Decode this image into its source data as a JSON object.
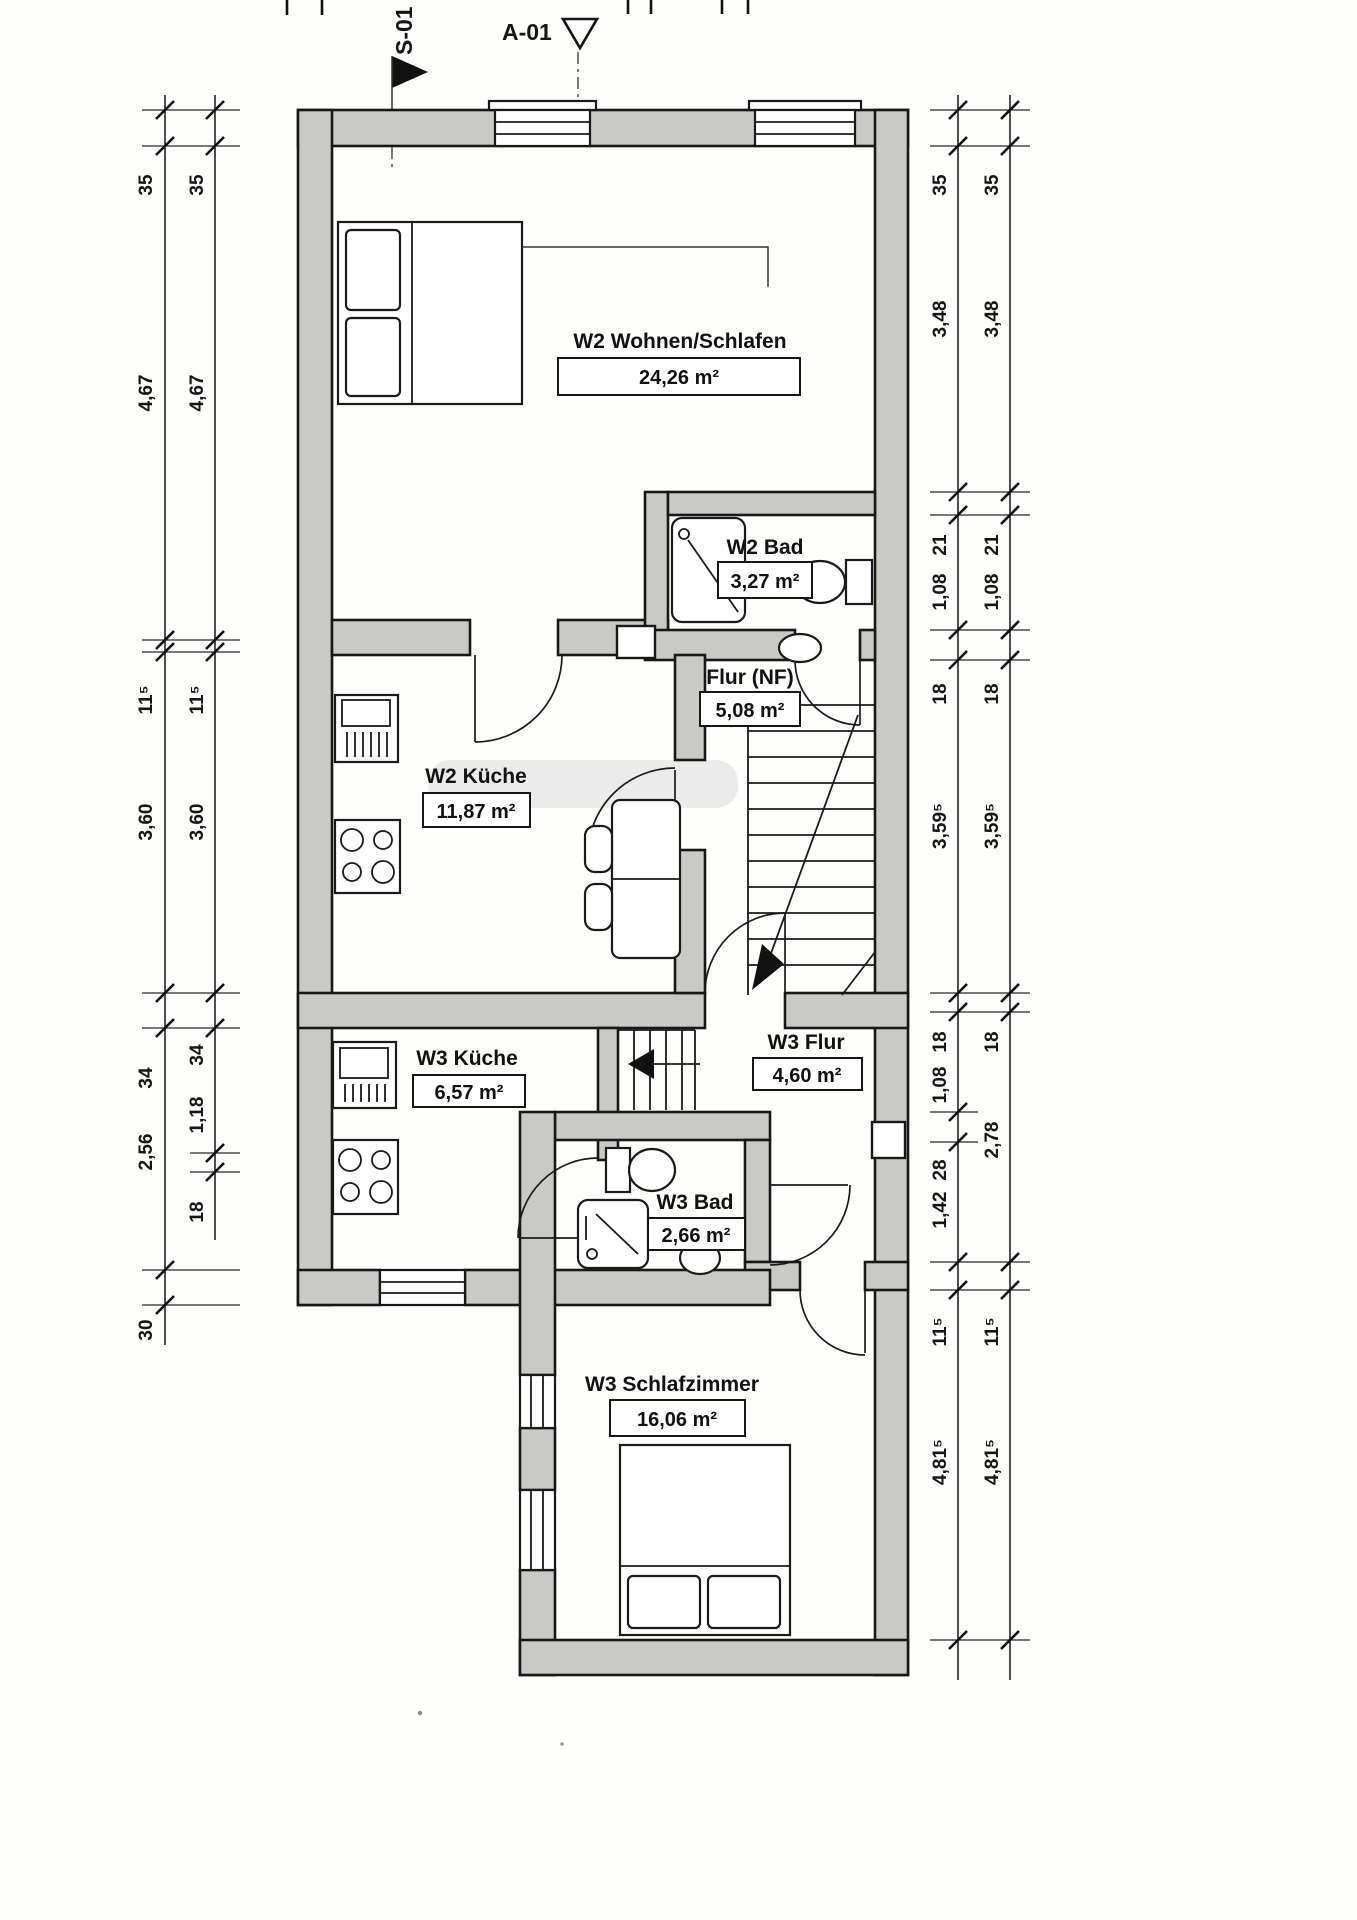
{
  "markers": {
    "section": "S-01",
    "detail": "A-01"
  },
  "rooms": {
    "w2_wohnen": {
      "label": "W2 Wohnen/Schlafen",
      "area": "24,26 m²"
    },
    "w2_bad": {
      "label": "W2 Bad",
      "area": "3,27 m²"
    },
    "flur_nf": {
      "label": "Flur (NF)",
      "area": "5,08 m²"
    },
    "w2_kueche": {
      "label": "W2 Küche",
      "area": "11,87 m²"
    },
    "w3_kueche": {
      "label": "W3 Küche",
      "area": "6,57 m²"
    },
    "w3_flur": {
      "label": "W3 Flur",
      "area": "4,60 m²"
    },
    "w3_bad": {
      "label": "W3 Bad",
      "area": "2,66 m²"
    },
    "w3_schlafzimmer": {
      "label": "W3 Schlafzimmer",
      "area": "16,06 m²"
    }
  },
  "dims": {
    "left_outer": [
      "35",
      "4,67",
      "11⁵",
      "3,60",
      "34",
      "2,56",
      "30"
    ],
    "left_inner": [
      "35",
      "4,67",
      "11⁵",
      "3,60",
      "34",
      "1,18",
      "18"
    ],
    "right_inner": [
      "35",
      "3,48",
      "21",
      "1,08",
      "18",
      "3,59⁵",
      "18",
      "1,08",
      "28",
      "1,42",
      "11⁵",
      "4,81⁵"
    ],
    "right_outer": [
      "35",
      "3,48",
      "21",
      "1,08",
      "18",
      "3,59⁵",
      "18",
      "2,78",
      "11⁵",
      "4,81⁵"
    ]
  },
  "colors": {
    "wall_fill": "#c9c9c6",
    "line": "#181818",
    "paper": "#fdfdfc"
  }
}
